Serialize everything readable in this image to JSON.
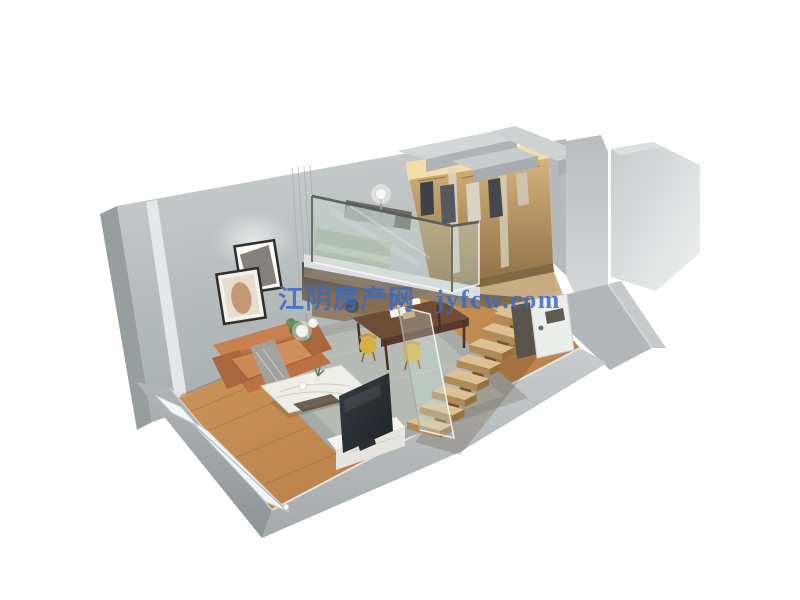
{
  "page": {
    "background_color": "#ffffff",
    "content_type": "3D isometric cutaway rendering of a loft apartment floor plan"
  },
  "watermark": {
    "text": "江阴房产网 jyfcw.com",
    "site_name": "江阴房产网",
    "site_domain": "jyfcw.com",
    "color": "#3a6bc3"
  },
  "scene": {
    "areas": [
      {
        "name": "living-room",
        "items": [
          "tan leather sofa",
          "gray throw blanket",
          "white marble coffee table",
          "gray area rug",
          "flat TV on white media console",
          "sphere floor lamp",
          "two framed wall pictures",
          "green plant"
        ]
      },
      {
        "name": "dining-area",
        "items": [
          "dark wood dining table",
          "yellow chairs",
          "tableware"
        ]
      },
      {
        "name": "loft-bedroom",
        "items": [
          "bed with sage green bedding",
          "gray pillows",
          "glass railing",
          "sphere table lamp"
        ]
      },
      {
        "name": "wardrobe-dressing-area",
        "items": [
          "open closet with hanging clothes",
          "warm cove lighting",
          "mirror divider panels"
        ]
      },
      {
        "name": "staircase",
        "items": [
          "open-riser wood stairs",
          "glass balustrade"
        ]
      },
      {
        "name": "bathroom",
        "items": [
          "white door with handle",
          "dark cabinet"
        ]
      },
      {
        "name": "balcony-edge",
        "items": [
          "narrow white window strip",
          "small corner window"
        ]
      }
    ],
    "colors": {
      "walls_gray": "#b5b9bb",
      "wall_caps": "#d2d6d7",
      "wood_floor": "#c08952",
      "stair_wood": "#ddc192",
      "sofa_tan": "#bf7a4e",
      "rug_gray": "#a6aba8",
      "closet_gold": "#c7a169",
      "dining_table_wood": "#6f4c34",
      "chair_yellow": "#d7ae3f",
      "tv_dark": "#2b2f33",
      "bedding_sage": "#a9b29f",
      "glass_tint": "#cde4e0"
    }
  }
}
